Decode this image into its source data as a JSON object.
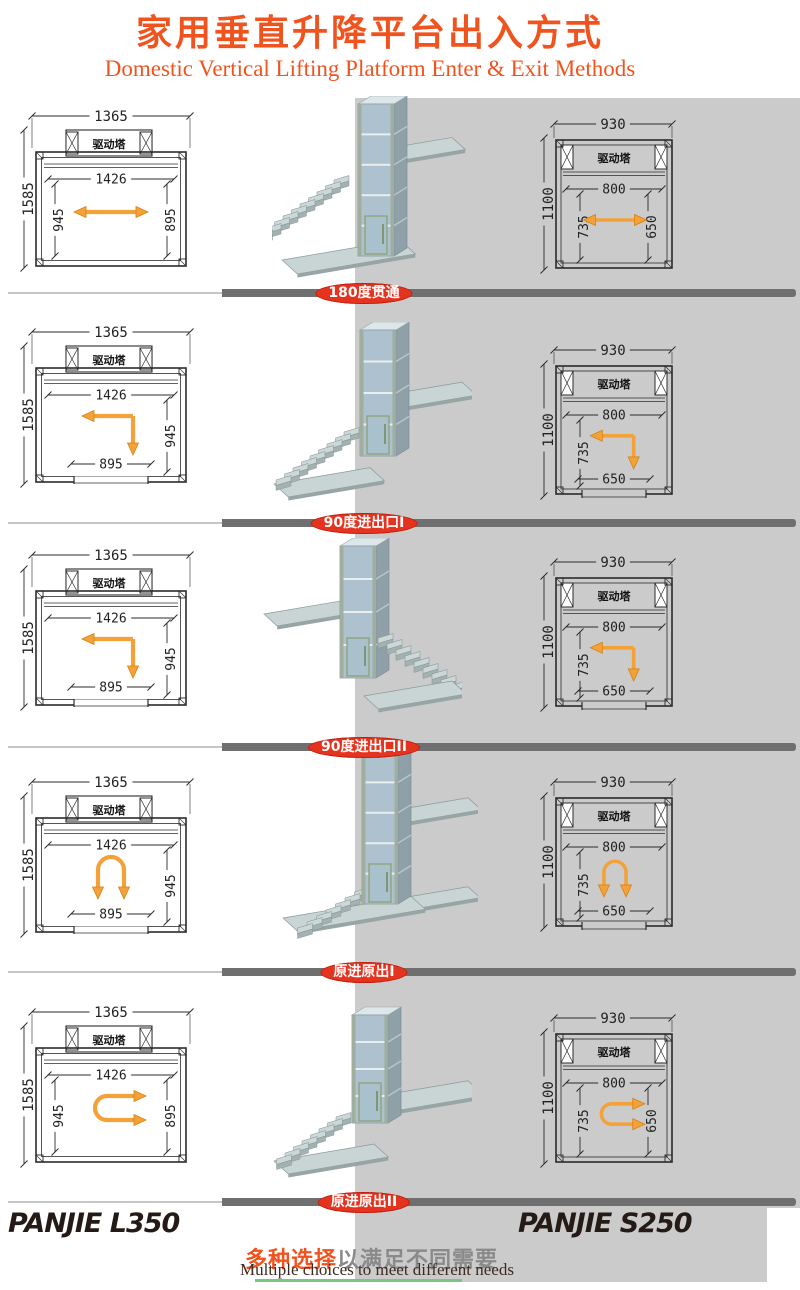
{
  "header": {
    "title_zh": "家用垂直升降平台出入方式",
    "title_en": "Domestic Vertical Lifting Platform Enter & Exit Methods"
  },
  "colors": {
    "accent_orange": "#f1531f",
    "label_red": "#e43420",
    "bar_dark": "#6f6f6f",
    "bar_light": "#c6c6c6",
    "gray_bg": "#cbcbcb",
    "arrow_orange": "#f3a139",
    "green_line": "#7cc57e"
  },
  "plans": {
    "left": {
      "outer_w": "1365",
      "outer_h": "1585",
      "inner_w": "1426",
      "tower": "驱动塔"
    },
    "right": {
      "outer_w": "930",
      "outer_h": "1100",
      "inner_w": "800",
      "tower": "驱动塔"
    }
  },
  "rows": [
    {
      "label": "180度贯通",
      "arrow": "h-double",
      "variant": "r1",
      "left_dims": {
        "left": "945",
        "right": "895"
      },
      "right_dims": {
        "left": "735",
        "right": "650"
      }
    },
    {
      "label": "90度进出口I",
      "arrow": "left-down",
      "variant": "r2",
      "left_dims": {
        "right": "945",
        "bottom": "895"
      },
      "right_dims": {
        "left": "735",
        "bottom": "650"
      }
    },
    {
      "label": "90度进出口II",
      "arrow": "left-down",
      "variant": "r3",
      "left_dims": {
        "right": "945",
        "bottom": "895"
      },
      "right_dims": {
        "left": "735",
        "bottom": "650"
      }
    },
    {
      "label": "原进原出I",
      "arrow": "u-down",
      "variant": "r4",
      "left_dims": {
        "right": "945",
        "bottom": "895"
      },
      "right_dims": {
        "left": "735",
        "bottom": "650"
      }
    },
    {
      "label": "原进原出II",
      "arrow": "u-right",
      "variant": "r5",
      "left_dims": {
        "left": "945",
        "right": "895"
      },
      "right_dims": {
        "left": "735",
        "right": "650"
      }
    }
  ],
  "footer": {
    "left_model": "PANJIE L350",
    "right_model": "PANJIE S250",
    "slogan_zh_highlight": "多种选择",
    "slogan_zh_rest": "以满足不同需要",
    "slogan_en": "Multiple choices to meet different needs"
  }
}
